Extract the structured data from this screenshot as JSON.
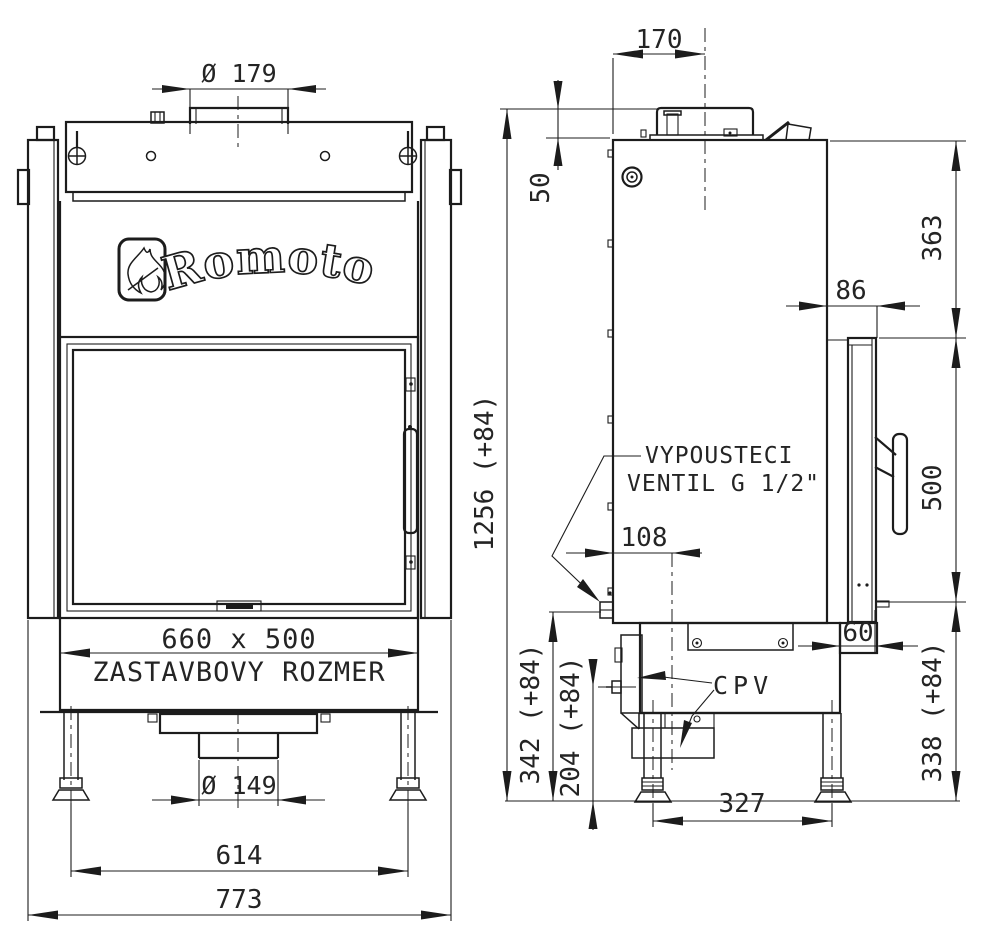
{
  "drawing": {
    "brand": "Romotop",
    "front_view": {
      "dim_flue_diameter": "Ø 179",
      "dim_build_size": "660 x 500",
      "label_build_size": "ZASTAVBOVY ROZMER",
      "dim_outlet_diameter": "Ø 149",
      "dim_feet_span": "614",
      "dim_overall_width": "773"
    },
    "side_view": {
      "dim_flue_center_offset": "170",
      "dim_collar_height": "50",
      "dim_overall_height": "1256 (+84)",
      "dim_top_to_door": "363",
      "dim_door_offset": "86",
      "dim_door_height": "500",
      "dim_valve_offset": "108",
      "dim_base_step": "60",
      "dim_valve_height": "342 (+84)",
      "dim_cpv_height": "204 (+84)",
      "dim_leg_span": "327",
      "dim_door_bottom_height": "338 (+84)",
      "label_drain_valve_line1": "VYPOUSTECI",
      "label_drain_valve_line2": "VENTIL G 1/2\"",
      "label_cpv": "CPV"
    },
    "colors": {
      "line": "#1c1c1c",
      "background": "#ffffff"
    }
  }
}
